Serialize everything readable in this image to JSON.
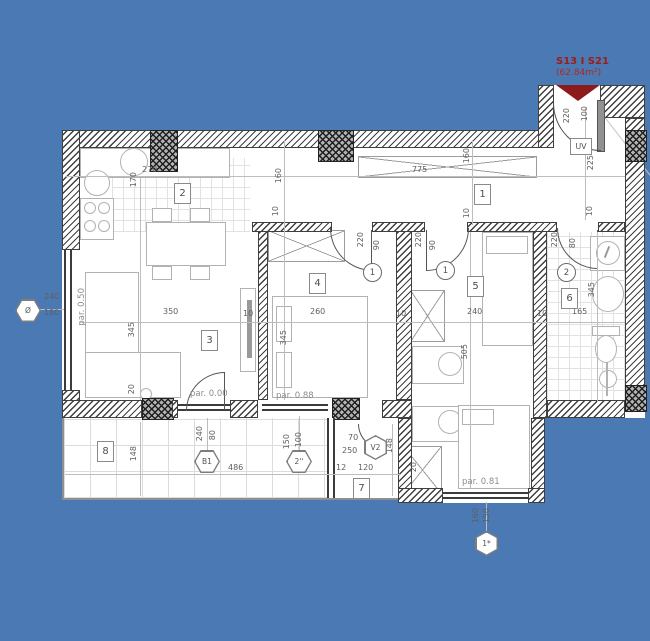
{
  "colors": {
    "background": "#4b79b4",
    "accent_red": "#8e1b1b",
    "wall_line": "#3f3f3f"
  },
  "title": {
    "unit": "S13 I S21",
    "area": "(62.84m²)"
  },
  "rooms": {
    "r1": "1",
    "r2": "2",
    "r3": "3",
    "r4": "4",
    "r5": "5",
    "r6": "6",
    "r7": "7",
    "r8": "8"
  },
  "door_tags": {
    "t1a": "1",
    "t1b": "1",
    "t2": "2",
    "entrance": "UV"
  },
  "markers": {
    "window_left": "Ø",
    "balcony_door": "B1",
    "loggia_door": "V2",
    "window_2": "2''",
    "window_1": "1*"
  },
  "levels": {
    "p000": "par. 0.00",
    "p050": "par. 0.50",
    "p088": "par. 0.88",
    "p081": "par. 0.81"
  },
  "dims": {
    "k270": "270",
    "k170": "170",
    "h775": "775",
    "h160a": "160",
    "h160b": "160",
    "t10a": "10",
    "t10b": "10",
    "t10c": "10",
    "l350": "350",
    "l345": "345",
    "r4w": "260",
    "r4h": "345",
    "r5w": "240",
    "r5h": "505",
    "b165": "165",
    "b345": "345",
    "w10a": "10",
    "w10b": "10",
    "w10c": "10",
    "d4a": "220",
    "d4b": "90",
    "d5a": "220",
    "d5b": "90",
    "d6a": "220",
    "d6b": "80",
    "e220": "220",
    "e100": "100",
    "e225": "225",
    "win240": "240",
    "win180": "180",
    "t148": "148",
    "t486": "486",
    "b1a": "240",
    "b1b": "80",
    "m2a": "150",
    "m2b": "100",
    "lg70": "70",
    "lg250": "250",
    "lg148": "148",
    "lg12": "12",
    "lg120": "120",
    "m1a": "160",
    "m1b": "150",
    "s20a": "20",
    "s20b": "20"
  }
}
